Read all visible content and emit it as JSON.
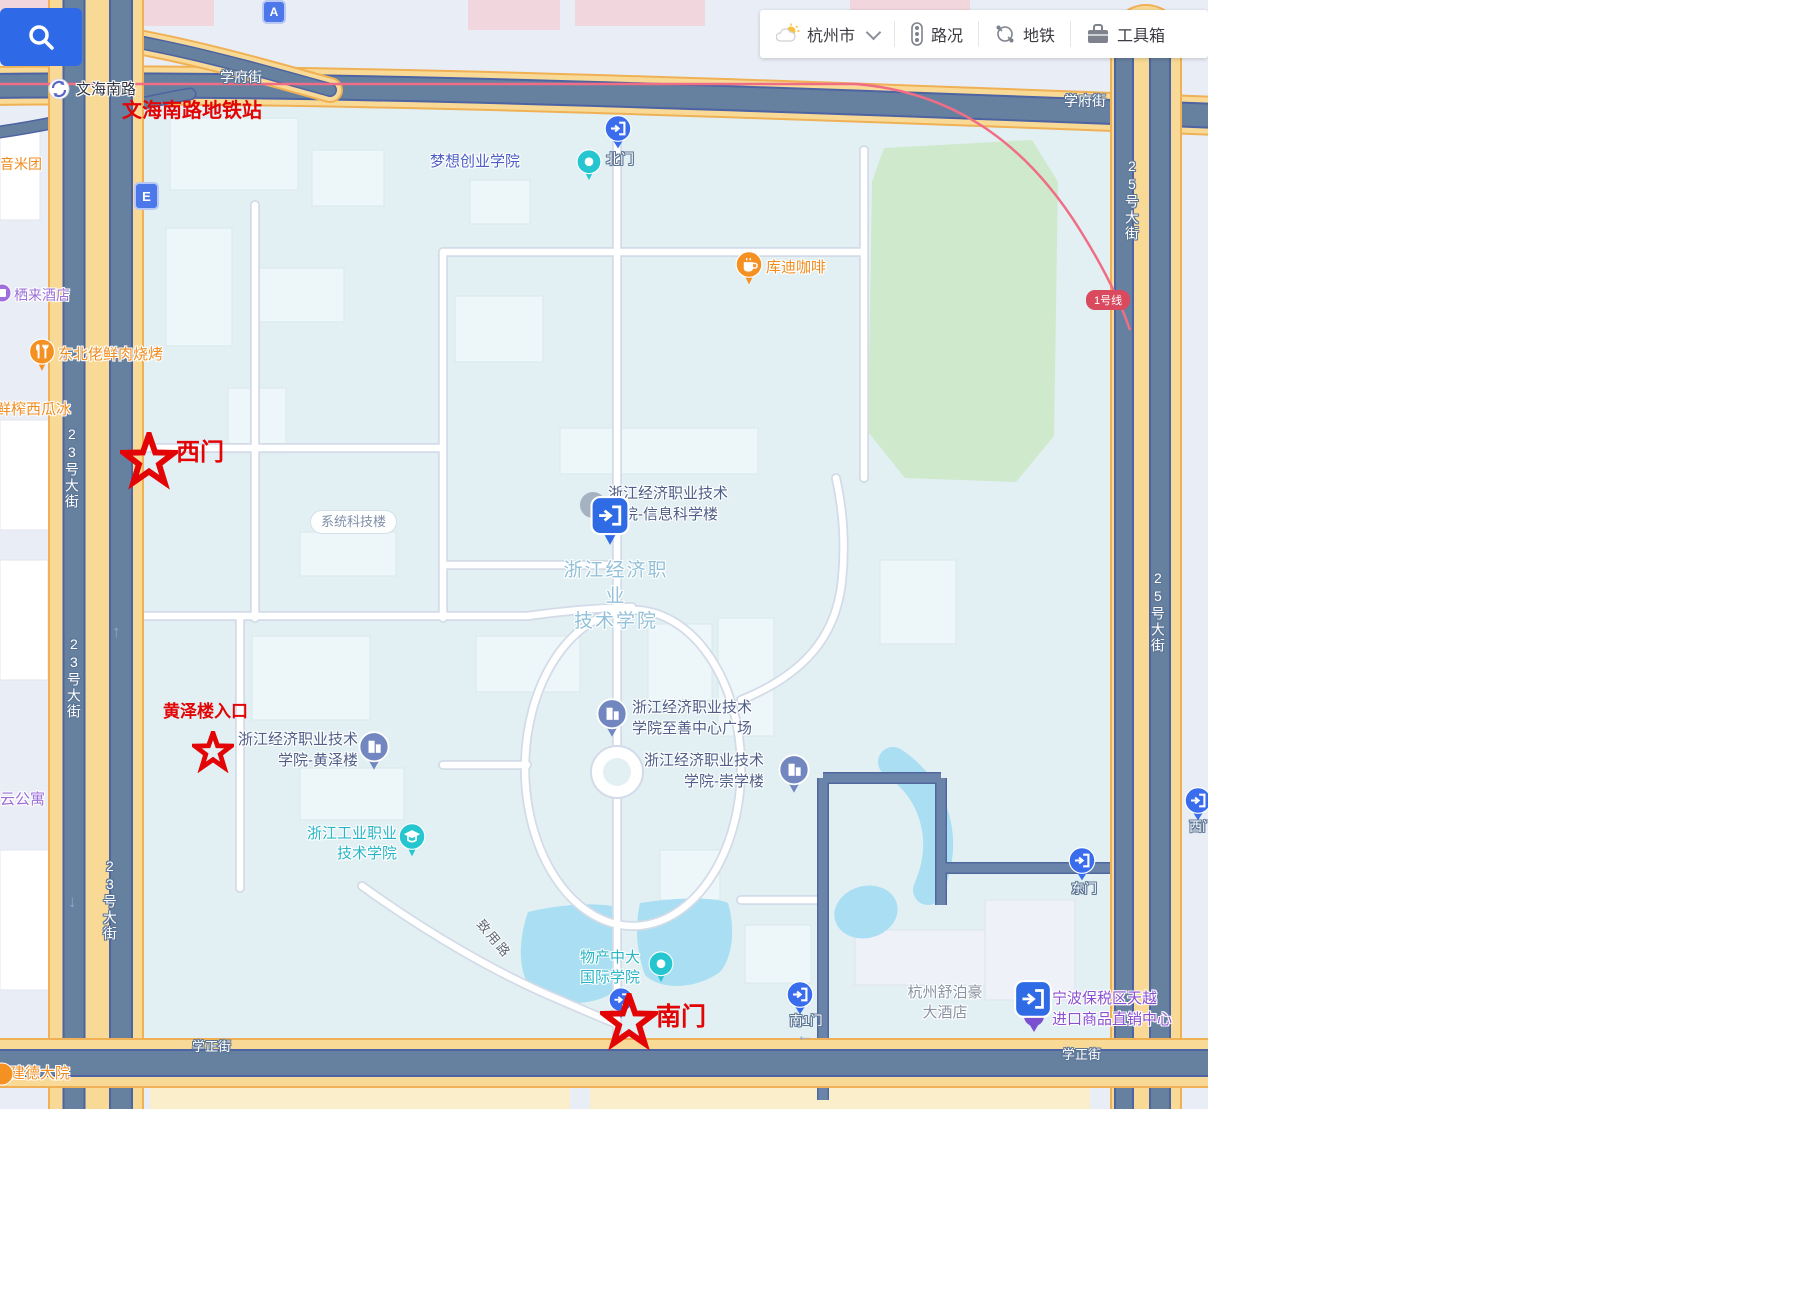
{
  "toolbar": {
    "city": "杭州市",
    "traffic": "路况",
    "metro": "地铁",
    "toolbox": "工具箱"
  },
  "red_notes": {
    "station": "文海南路地铁站",
    "west_gate": "西门",
    "huangze_entrance": "黄泽楼入口",
    "south_gate": "南门",
    "color": "#e30505"
  },
  "streets": {
    "xuefu": "学府街",
    "xuezheng": "学正街",
    "st23": "23号大街",
    "st25": "25号大街",
    "wenhai": "文海南路",
    "zhiyong": "致用路"
  },
  "badges": {
    "a": "A",
    "e": "E",
    "line1": "1号线"
  },
  "gates": {
    "north": "北门",
    "south1": "南1门",
    "east": "东门",
    "west_edge": "西门"
  },
  "pois": {
    "dream": "梦想创业学院",
    "kudi": "库迪咖啡",
    "yinmituan": "音米团",
    "qilai": "栖来酒店",
    "bbq": "东北佬鲜肉烧烤",
    "watermelon": "鲜榨西瓜冰",
    "yun": "云公寓",
    "jiande": "建德大院",
    "system_tech": "系统科技楼",
    "info_building": "浙江经济职业技术\n学院-信息科学楼",
    "campus": "浙江经济职业\n技术学院",
    "zhishan": "浙江经济职业技术\n学院至善中心广场",
    "chongxue": "浙江经济职业技术\n学院-崇学楼",
    "huangze": "浙江经济职业技术\n学院-黄泽楼",
    "gongye": "浙江工业职业\n技术学院",
    "wuchan": "物产中大\n国际学院",
    "hotel": "杭州舒泊豪\n大酒店",
    "ningbo": "宁波保税区天越\n进口商品直销中心"
  },
  "colors": {
    "road_slate": "#66809f",
    "road_yellow": "#f8da96",
    "campus_bg": "#e2f0f3",
    "water": "#a9def3",
    "green": "#cfe9cc",
    "metro_line": "#ef6e86",
    "pin_blue": "#3a6ded",
    "pin_teal": "#26c6d0",
    "pin_orange": "#f59122",
    "search_blue": "#2e6ae8"
  }
}
